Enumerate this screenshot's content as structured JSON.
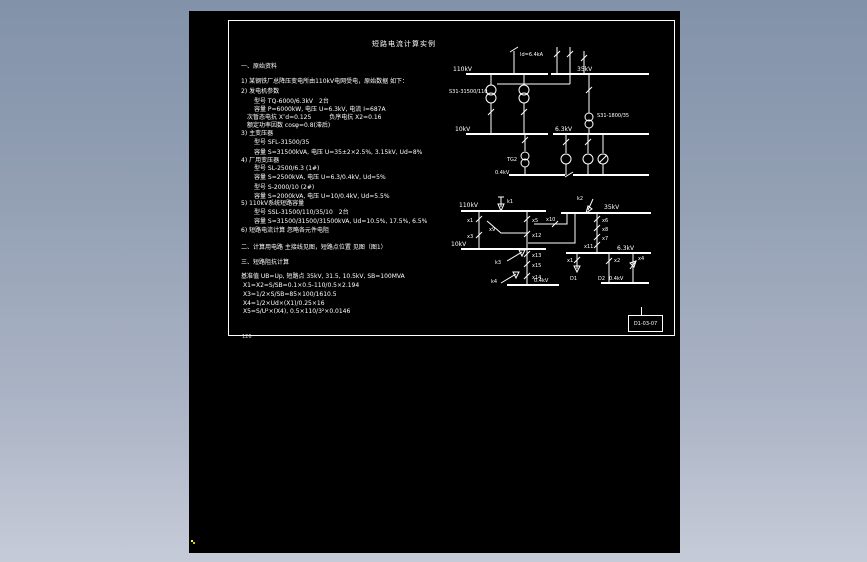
{
  "colors": {
    "desktop_top": "#8292a9",
    "desktop_bottom": "#c6cbd8",
    "canvas_bg": "#000000",
    "line_color": "#ffffff",
    "cursor_dot": "#ffff00"
  },
  "sheet": {
    "title": "短路电流计算实例",
    "page_number": "126",
    "titleblock_code": "D1-03-07",
    "text_lines": [
      {
        "t": "一、原始资料",
        "x": 12,
        "y": 42
      },
      {
        "t": "1) 某钢铁厂总降压变电所由110kV电网受电，原始数据 如下：",
        "x": 12,
        "y": 57
      },
      {
        "t": "2) 发电机参数",
        "x": 12,
        "y": 67
      },
      {
        "t": "型号 TQ-6000/6.3kV　2台",
        "x": 25,
        "y": 77
      },
      {
        "t": "容量 P=6000kW, 电压 U=6.3kV, 电流 I=687A",
        "x": 25,
        "y": 85
      },
      {
        "t": "次暂态电抗 X″d=0.125　　　负序电抗 X2=0.16",
        "x": 18,
        "y": 93
      },
      {
        "t": "额定功率因数 cosφ=0.8(滞后)",
        "x": 18,
        "y": 101
      },
      {
        "t": "3) 主变压器",
        "x": 12,
        "y": 109
      },
      {
        "t": "型号 SFL-31500/35",
        "x": 25,
        "y": 118
      },
      {
        "t": "容量 S=31500kVA, 电压 U=35±2×2.5%, 3.15kV, Ud=8%",
        "x": 25,
        "y": 128
      },
      {
        "t": "4) 厂用变压器",
        "x": 12,
        "y": 136
      },
      {
        "t": "型号 SL-2500/6.3 (1#)",
        "x": 25,
        "y": 144
      },
      {
        "t": "容量 S=2500kVA, 电压 U=6.3/0.4kV, Ud=5%",
        "x": 25,
        "y": 153
      },
      {
        "t": "型号 S-2000/10 (2#)",
        "x": 25,
        "y": 163
      },
      {
        "t": "容量 S=2000kVA, 电压 U=10/0.4kV, Ud=5.5%",
        "x": 25,
        "y": 172
      },
      {
        "t": "5) 110kV系统短路容量",
        "x": 12,
        "y": 179
      },
      {
        "t": "型号 SSL-31500/110/35/10　2台",
        "x": 25,
        "y": 188
      },
      {
        "t": "容量 S=31500/31500/31500kVA, Ud=10.5%, 17.5%, 6.5%",
        "x": 25,
        "y": 197
      },
      {
        "t": "6) 短路电流计算 忽略各元件电阻",
        "x": 12,
        "y": 206
      },
      {
        "t": "二、计算用电路 主接线见图，短路点位置 见图（图1）",
        "x": 12,
        "y": 223
      },
      {
        "t": "三、短路阻抗计算",
        "x": 12,
        "y": 238
      },
      {
        "t": "基准值 UB=Up, 短路点 35kV, 31.5, 10.5kV, SB=100MVA",
        "x": 12,
        "y": 252
      },
      {
        "t": "X1=X2=S/SB=0.1×0.5-110/0.5×2.194",
        "x": 14,
        "y": 261
      },
      {
        "t": "X3=1/2×S/SB=85×100/1610.5",
        "x": 14,
        "y": 270
      },
      {
        "t": "X4=1/2×Ud×(X1)/0.25×16",
        "x": 14,
        "y": 279
      },
      {
        "t": "X5=S/U²×(X4), 0.5×110/3²×0.0146",
        "x": 14,
        "y": 287
      }
    ]
  },
  "diagram1": {
    "labels": {
      "source_current": "Id=6.4kA",
      "bus110": "110kV",
      "bus35": "35kV",
      "bus10": "10kV",
      "bus63": "6.3kV",
      "bus04": "0.4kV",
      "tx_main": "S31-31500/110",
      "tx_aux": "S31-1800/35",
      "tg2": "TG2"
    }
  },
  "diagram2": {
    "labels": {
      "bus110": "110kV",
      "bus35": "35kV",
      "bus10": "10kV",
      "bus63": "6.3kV",
      "bus04a": "0.4kV",
      "bus04b": "0.4kV",
      "k1": "k1",
      "k2": "k2",
      "k3": "k3",
      "k4": "k4",
      "x1": "x1",
      "x3": "x3",
      "x5": "x5",
      "x9": "x9",
      "x10": "x10",
      "x12": "x12",
      "x13": "x13",
      "x15": "x15",
      "x14": "x14",
      "x6": "x6",
      "x8": "x8",
      "x7": "x7",
      "x11": "x11",
      "xb1": "x1",
      "xb2": "x2",
      "xb4": "x4",
      "d1": "D1",
      "d2": "D2"
    }
  }
}
